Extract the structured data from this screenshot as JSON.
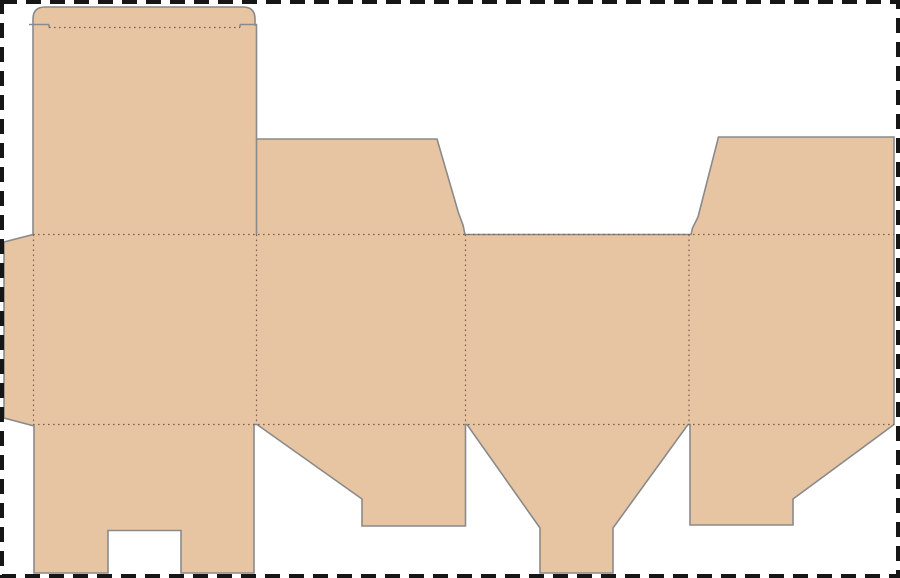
{
  "canvas": {
    "width": 900,
    "height": 578,
    "background_color": "#ffffff"
  },
  "page_border": {
    "color": "#161616",
    "thickness": 4,
    "dash_length": 15,
    "dash_gap": 9,
    "x": 2,
    "y": 2,
    "width": 896,
    "height": 574
  },
  "dieline": {
    "fill_color": "#e7c4a2",
    "cut_line_color": "#8a8a8a",
    "cut_line_width": 1.6,
    "fold_line_color": "#7d6250",
    "fold_line_width": 1.2,
    "fold_dash": "1.6 3.4",
    "outline_path": "M 33 25 L 33 19 Q 33 7 45 7 L 243 7 Q 255 7 255 19 L 255 25 L 256.5 25 L 256.5 139 L 437 139 L 458.5 213 L 463 225 L 465 234.5 L 691 234.5 L 692.5 228 L 698 217 L 718.5 137 L 894 137 L 894 424.5 L 793 499 L 793 525 L 690 525 L 690 424.5 L 688 424.5 L 613 528 L 613 573 L 540 573 L 540 528 L 467 424.5 L 465.5 424.5 L 465.5 526 L 362 526 L 362 499 L 257 424.5 L 254 424.5 L 254 573 L 181 573 L 181 530.5 L 108 530.5 L 108 573 L 34 573 L 34 426 L 4 418 L 4 242 L 33 234.5 Z",
    "cut_segments": [
      {
        "x1": 29,
        "y1": 24.5,
        "x2": 49,
        "y2": 24.5
      },
      {
        "x1": 49,
        "y1": 24.5,
        "x2": 49,
        "y2": 27.5
      },
      {
        "x1": 240,
        "y1": 24.5,
        "x2": 257,
        "y2": 24.5
      },
      {
        "x1": 240,
        "y1": 24.5,
        "x2": 240,
        "y2": 27.5
      },
      {
        "x1": 256.5,
        "y1": 139,
        "x2": 256.5,
        "y2": 234.5
      }
    ],
    "fold_segments": [
      {
        "x1": 49,
        "y1": 27.5,
        "x2": 240,
        "y2": 27.5
      },
      {
        "x1": 33,
        "y1": 234.5,
        "x2": 894,
        "y2": 234.5
      },
      {
        "x1": 33,
        "y1": 424.5,
        "x2": 894,
        "y2": 424.5
      },
      {
        "x1": 33.5,
        "y1": 234.5,
        "x2": 33.5,
        "y2": 424.5
      },
      {
        "x1": 256.5,
        "y1": 234.5,
        "x2": 256.5,
        "y2": 424.5
      },
      {
        "x1": 465.5,
        "y1": 234.5,
        "x2": 465.5,
        "y2": 424.5
      },
      {
        "x1": 689,
        "y1": 234.5,
        "x2": 689,
        "y2": 424.5
      }
    ]
  }
}
